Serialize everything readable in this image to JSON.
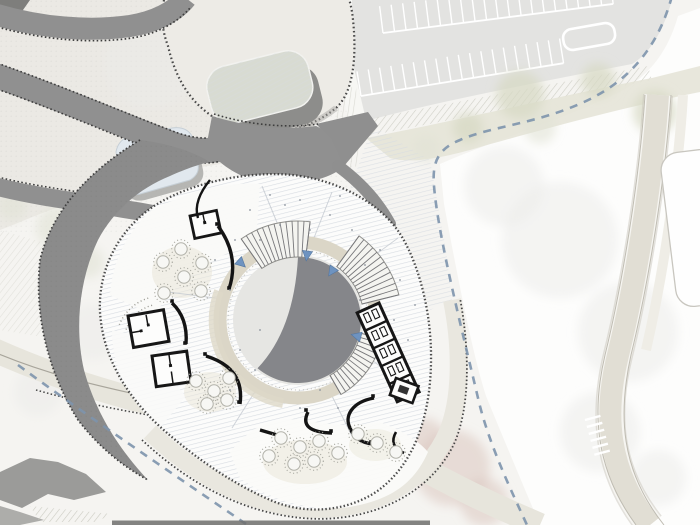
{
  "document": {
    "kind": "architectural-site-plan",
    "view": "ground-floor-site-plan"
  },
  "colors": {
    "background": "#f5f4f1",
    "plaza": "#ebe9e4",
    "mound": "#edebe6",
    "lawn": "#fdfdfc",
    "asphalt": "#e3e3e1",
    "veg_strip": "#e4e3d6",
    "pond": "#e1e8ee",
    "court_green": "#d8dbd2",
    "shadow_gray": "#8d8d8b",
    "path_gray": "#909090",
    "berm_gray": "#8b8b8b",
    "roof_white": "#fcfcfb",
    "ring_sand": "#dbd6c7",
    "courtyard_light": "#e6e6e3",
    "courtyard_shadow": "#85868a",
    "wall_black": "#161616",
    "entrance_blue": "#6e93c0",
    "boundary_blue": "#7d93ac",
    "road_beige": "#e1ded4",
    "tree_green": "#d7dac4",
    "sage_green": "#e1e3d5",
    "tree_pink": "#dbc7c0",
    "cloud_gray": "#ececea",
    "bottom_bar": "#6f6f6d"
  },
  "plan": {
    "parking_rows": [
      {
        "x": 383,
        "y": 33,
        "angle": -7.2,
        "count": 20,
        "step": 11.6,
        "depth": 27
      },
      {
        "x": 361,
        "y": 96,
        "angle": -9.2,
        "count": 18,
        "step": 11.4,
        "depth": 25
      }
    ],
    "stair_fans": [
      {
        "cx": 298,
        "cy": 320,
        "r1": 63,
        "r2": 99,
        "a1": -125,
        "a2": -83,
        "n": 12
      },
      {
        "cx": 298,
        "cy": 320,
        "r1": 66,
        "r2": 104,
        "a1": -54,
        "a2": -14,
        "n": 12
      },
      {
        "cx": 298,
        "cy": 320,
        "r1": 64,
        "r2": 86,
        "a1": 12,
        "a2": 60,
        "n": 13
      }
    ],
    "seat_arcs": [
      {
        "cx": 162,
        "cy": 342,
        "r": 22,
        "a1": 195,
        "a2": 262
      },
      {
        "cx": 162,
        "cy": 342,
        "r": 30,
        "a1": 197,
        "a2": 260
      },
      {
        "cx": 162,
        "cy": 342,
        "r": 38,
        "a1": 199,
        "a2": 258
      },
      {
        "cx": 162,
        "cy": 342,
        "r": 46,
        "a1": 202,
        "a2": 254
      }
    ],
    "tables": [
      [
        163,
        262
      ],
      [
        181,
        249
      ],
      [
        184,
        277
      ],
      [
        202,
        263
      ],
      [
        201,
        291
      ],
      [
        164,
        293
      ],
      [
        196,
        381
      ],
      [
        214,
        391
      ],
      [
        229,
        378
      ],
      [
        207,
        404
      ],
      [
        227,
        400
      ],
      [
        281,
        438
      ],
      [
        300,
        447
      ],
      [
        319,
        441
      ],
      [
        338,
        453
      ],
      [
        358,
        434
      ],
      [
        377,
        443
      ],
      [
        294,
        464
      ],
      [
        314,
        461
      ],
      [
        269,
        456
      ],
      [
        396,
        452
      ]
    ],
    "entrance_arrows": [
      [
        241,
        263,
        133
      ],
      [
        307,
        255,
        188
      ],
      [
        332,
        271,
        214
      ],
      [
        357,
        336,
        285
      ]
    ],
    "trees": [
      [
        520,
        95,
        24,
        "green"
      ],
      [
        598,
        80,
        17,
        "green"
      ],
      [
        655,
        112,
        22,
        "green"
      ],
      [
        468,
        128,
        15,
        "green"
      ],
      [
        540,
        128,
        16,
        "sage"
      ],
      [
        426,
        148,
        13,
        "sage"
      ],
      [
        58,
        228,
        22,
        "sage"
      ],
      [
        12,
        206,
        15,
        "sage"
      ],
      [
        88,
        262,
        16,
        "sage"
      ],
      [
        452,
        468,
        38,
        "pink"
      ],
      [
        424,
        440,
        22,
        "pink"
      ],
      [
        484,
        502,
        24,
        "pink"
      ],
      [
        697,
        215,
        20,
        "pink"
      ],
      [
        560,
        240,
        58,
        "cloud"
      ],
      [
        628,
        332,
        50,
        "cloud"
      ],
      [
        504,
        186,
        40,
        "cloud"
      ],
      [
        600,
        432,
        40,
        "cloud"
      ],
      [
        92,
        332,
        28,
        "cloud"
      ],
      [
        38,
        392,
        24,
        "cloud"
      ],
      [
        658,
        478,
        28,
        "cloud"
      ],
      [
        150,
        62,
        46,
        "cloud"
      ]
    ],
    "roof_specks": [
      [
        250,
        210
      ],
      [
        270,
        195
      ],
      [
        300,
        200
      ],
      [
        330,
        215
      ],
      [
        352,
        230
      ],
      [
        340,
        196
      ],
      [
        310,
        230
      ],
      [
        280,
        225
      ],
      [
        260,
        240
      ],
      [
        380,
        250
      ],
      [
        400,
        280
      ],
      [
        394,
        320
      ],
      [
        408,
        340
      ],
      [
        398,
        368
      ],
      [
        260,
        330
      ],
      [
        240,
        350
      ],
      [
        255,
        370
      ],
      [
        230,
        390
      ],
      [
        320,
        390
      ],
      [
        338,
        408
      ],
      [
        300,
        408
      ],
      [
        360,
        300
      ],
      [
        230,
        290
      ],
      [
        215,
        260
      ],
      [
        235,
        240
      ],
      [
        285,
        205
      ],
      [
        365,
        265
      ],
      [
        415,
        305
      ]
    ]
  }
}
